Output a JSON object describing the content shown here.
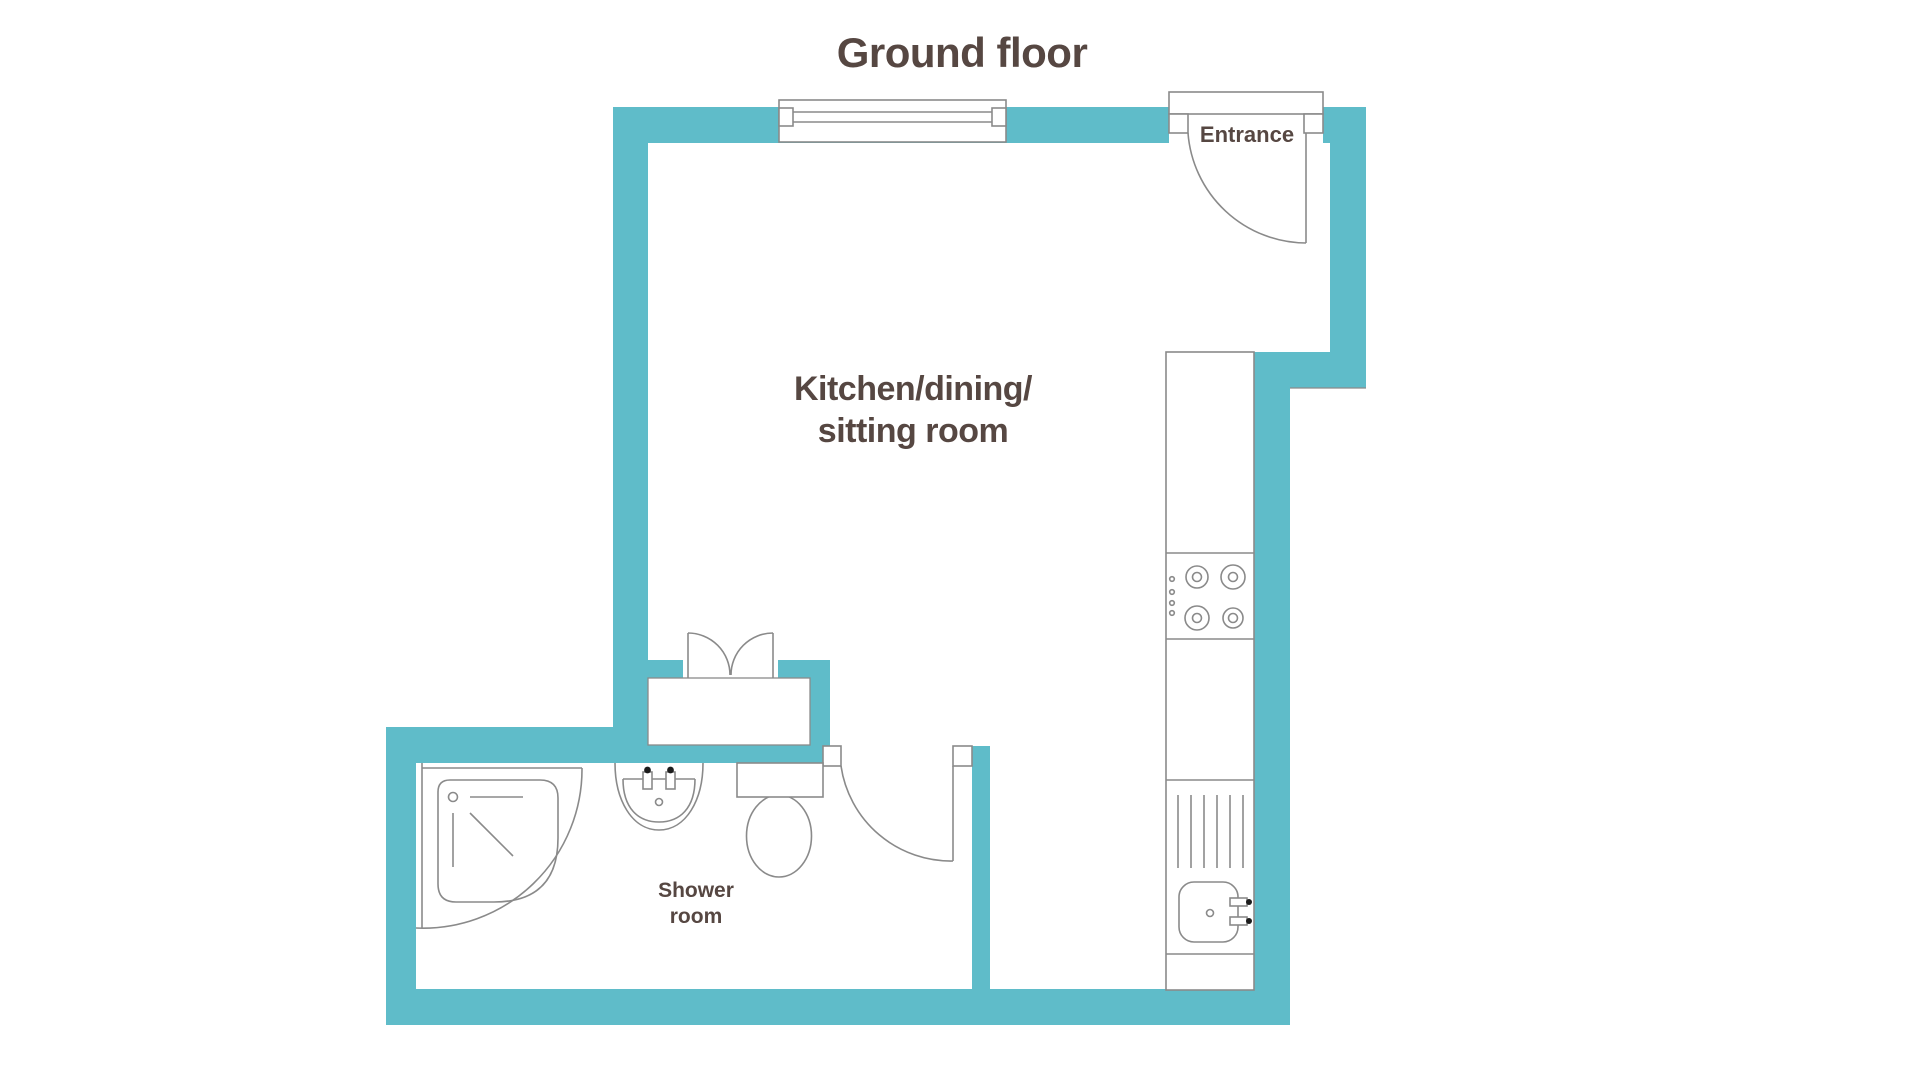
{
  "title": "Ground floor",
  "rooms": {
    "main": {
      "line1": "Kitchen/dining/",
      "line2": "sitting room"
    },
    "shower": {
      "line1": "Shower",
      "line2": "room"
    },
    "entrance": {
      "label": "Entrance"
    }
  },
  "fixtures": [
    "window",
    "entrance-door",
    "double-doors",
    "shower-door",
    "corner-shower",
    "washbasin",
    "toilet",
    "kitchen-counter",
    "hob",
    "draining-board",
    "kitchen-sink"
  ],
  "colors": {
    "wall": "#5fbcc9",
    "line": "#8a8a8a",
    "text": "#564742",
    "paper": "#ffffff"
  }
}
